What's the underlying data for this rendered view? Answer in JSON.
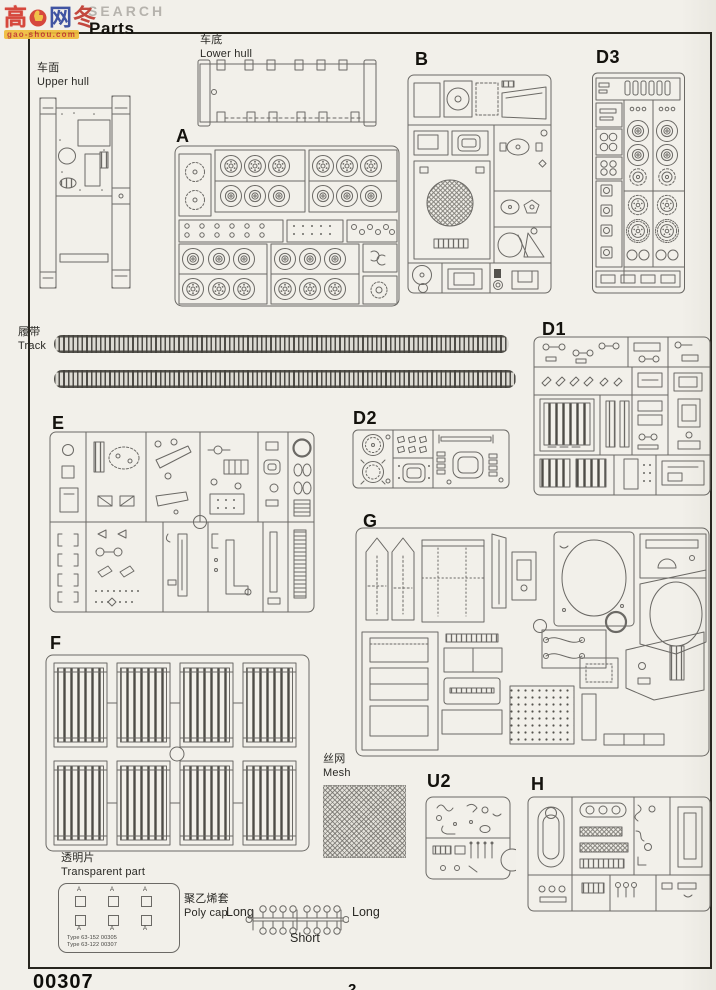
{
  "header": {
    "overlay_text": "SEARCH",
    "title": "Parts",
    "watermark": {
      "char1": "高",
      "char2": "网",
      "char3": "冬",
      "domain": "gao-shou.com"
    }
  },
  "sections": {
    "upper_hull": {
      "cn": "车面",
      "en": "Upper hull"
    },
    "lower_hull": {
      "cn": "车底",
      "en": "Lower hull"
    },
    "track": {
      "cn": "履带",
      "en": "Track"
    },
    "mesh": {
      "cn": "丝网",
      "en": "Mesh"
    },
    "transparent": {
      "cn": "透明片",
      "en": "Transparent part",
      "part_letter": "A",
      "type_line1": "Type 63-152 00305",
      "type_line2": "Type 63-122 00307"
    },
    "polycap": {
      "cn": "聚乙烯套",
      "en": "Poly cap",
      "long_left": "Long",
      "short_label": "Short",
      "long_right": "Long"
    }
  },
  "sprues": {
    "a": "A",
    "b": "B",
    "d1": "D1",
    "d2": "D2",
    "d3": "D3",
    "e": "E",
    "f": "F",
    "g": "G",
    "h": "H",
    "u2": "U2"
  },
  "footer": {
    "kit_number": "00307",
    "page_number": "2"
  }
}
